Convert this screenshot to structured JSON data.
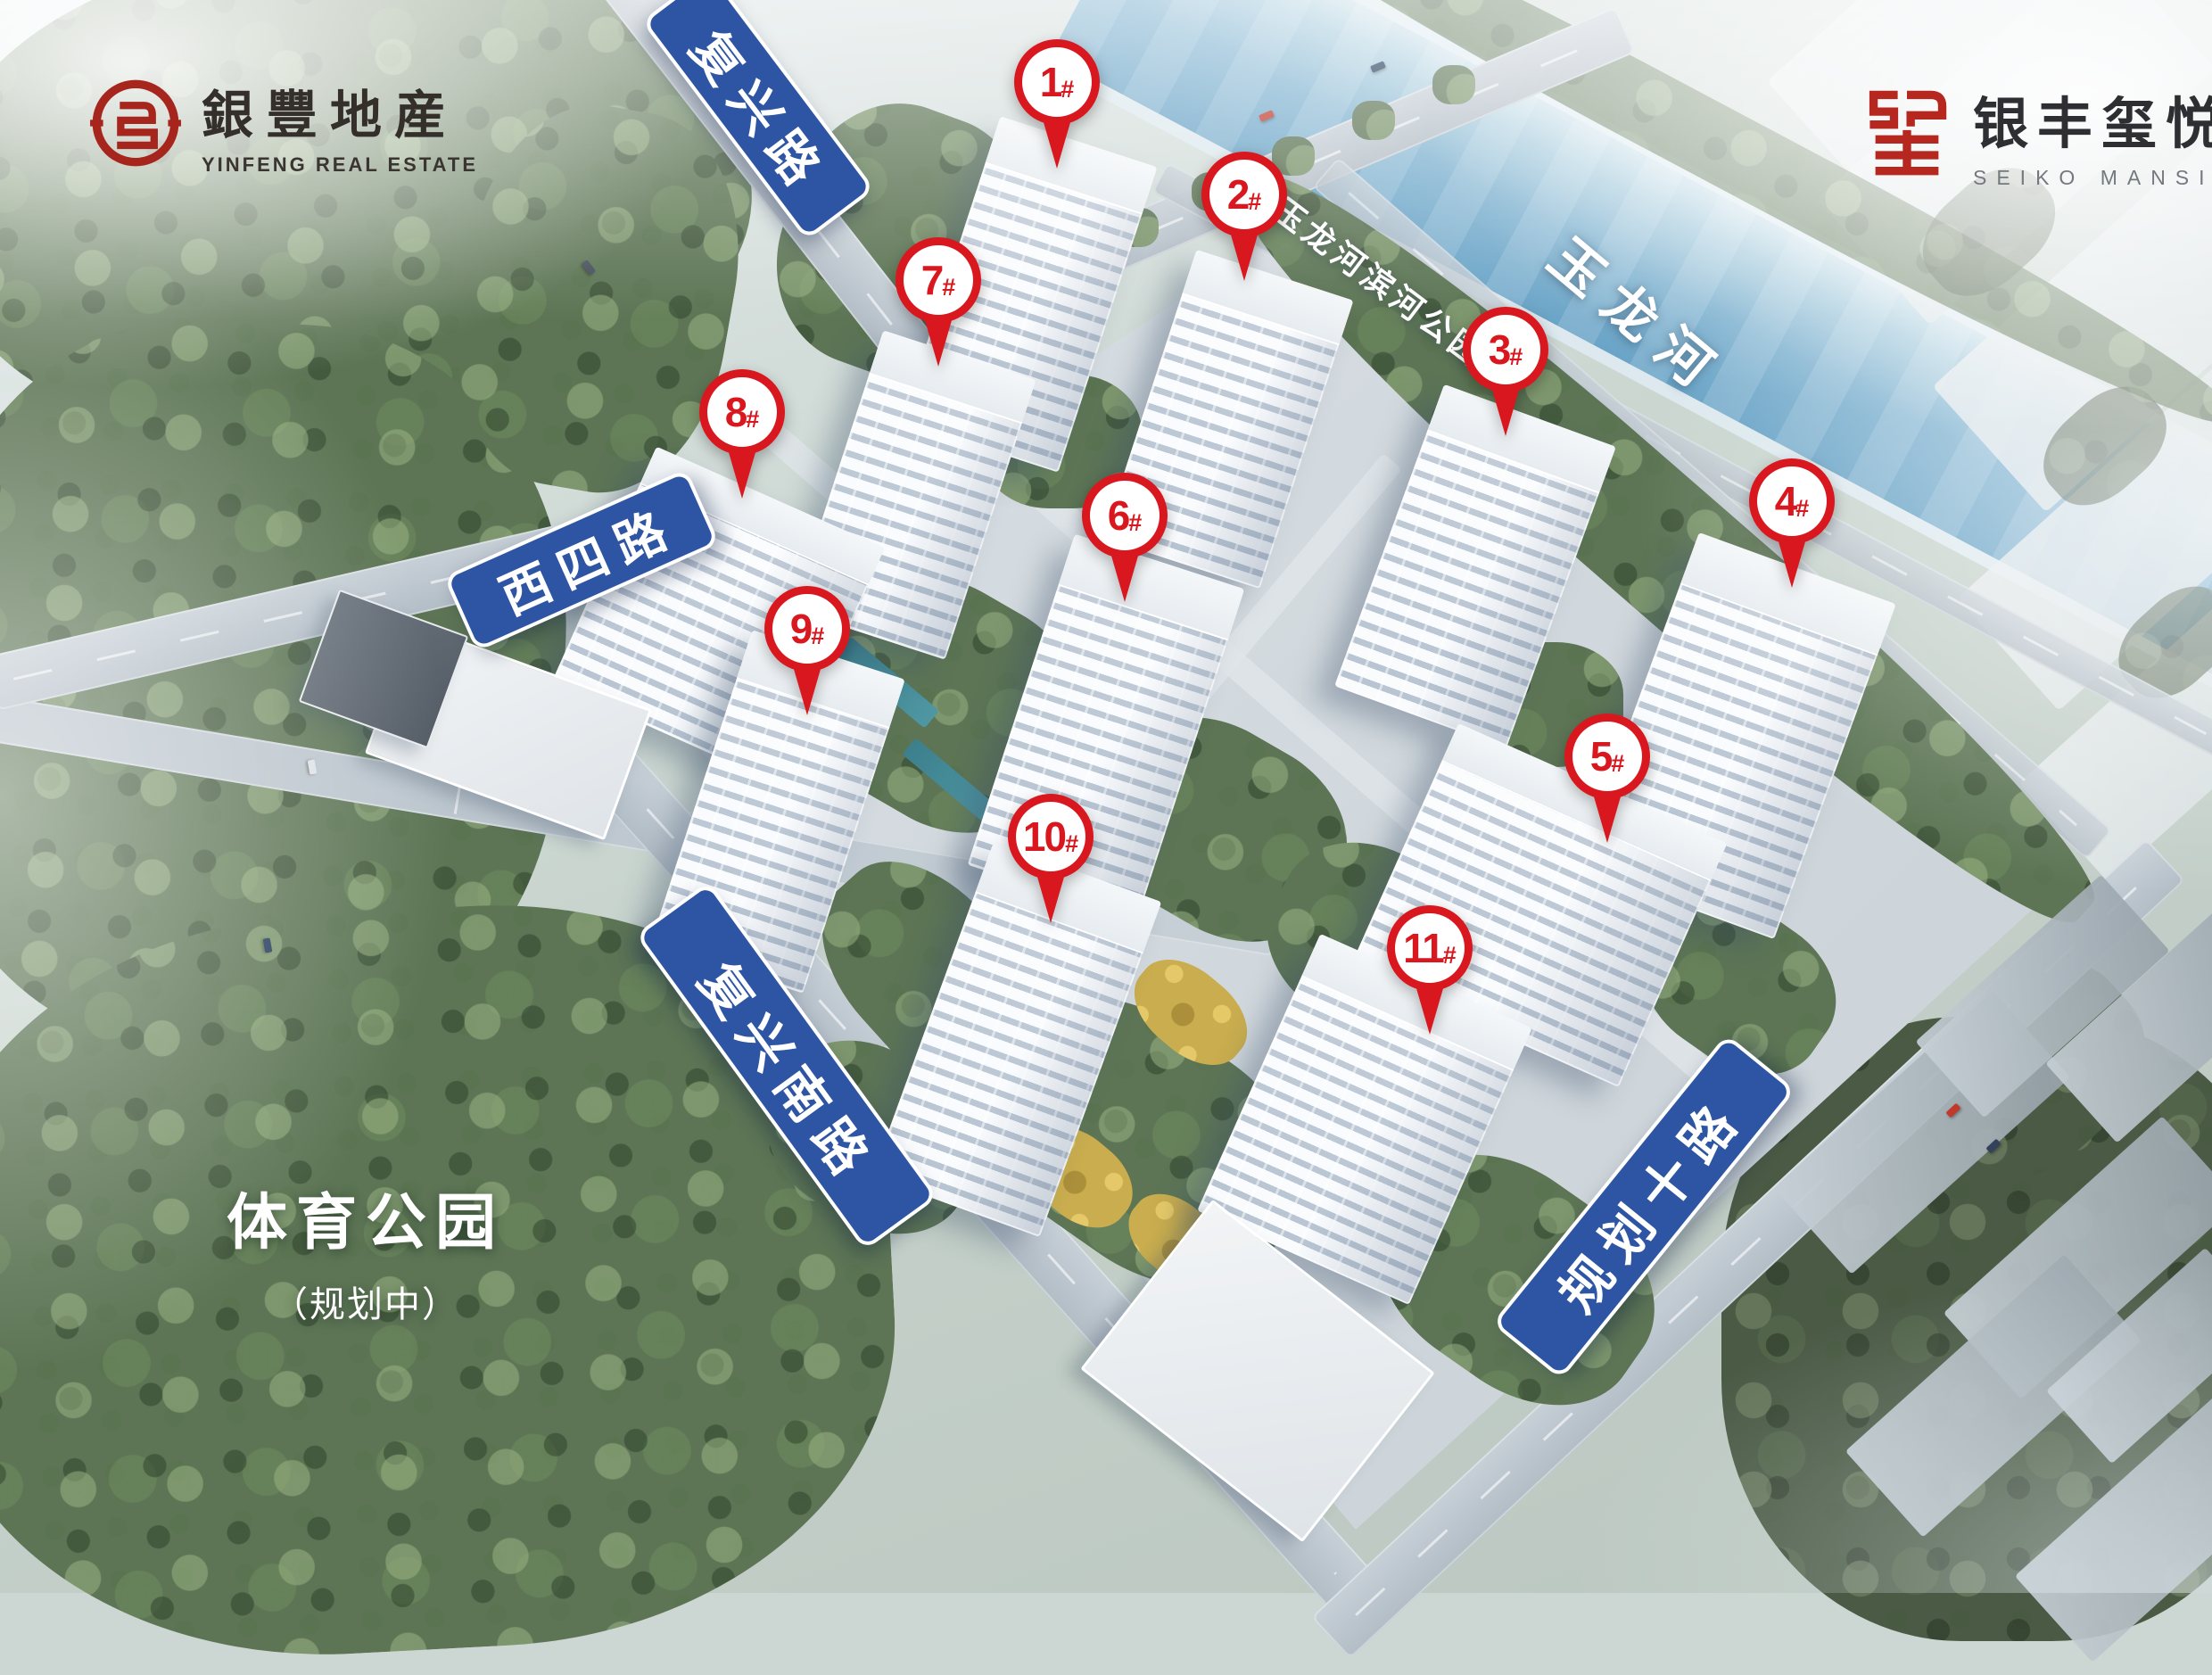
{
  "header": {
    "logo_left": {
      "cn": "銀豐地産",
      "en": "YINFENG REAL ESTATE"
    },
    "logo_right": {
      "cn": "银丰玺悦",
      "en": "SEIKO MANSION"
    }
  },
  "road_signs": {
    "fuxing": "复兴路",
    "xisi": "西四路",
    "fuxingnan": "复兴南路",
    "guihuashi": "规划十路"
  },
  "place_labels": {
    "river": "玉龙河",
    "river_park": "玉龙河滨河公园",
    "sports_park": "体育公园",
    "sports_park_note": "（规划中）"
  },
  "markers": [
    {
      "num": "1",
      "suffix": "#",
      "label": "1#"
    },
    {
      "num": "2",
      "suffix": "#",
      "label": "2#"
    },
    {
      "num": "3",
      "suffix": "#",
      "label": "3#"
    },
    {
      "num": "4",
      "suffix": "#",
      "label": "4#"
    },
    {
      "num": "5",
      "suffix": "#",
      "label": "5#"
    },
    {
      "num": "6",
      "suffix": "#",
      "label": "6#"
    },
    {
      "num": "7",
      "suffix": "#",
      "label": "7#"
    },
    {
      "num": "8",
      "suffix": "#",
      "label": "8#"
    },
    {
      "num": "9",
      "suffix": "#",
      "label": "9#"
    },
    {
      "num": "10",
      "suffix": "#",
      "label": "10#"
    },
    {
      "num": "11",
      "suffix": "#",
      "label": "11#"
    }
  ],
  "colors": {
    "marker_red": "#d9171e",
    "sign_blue": "#2e55a3",
    "logo_red": "#a6251d"
  }
}
